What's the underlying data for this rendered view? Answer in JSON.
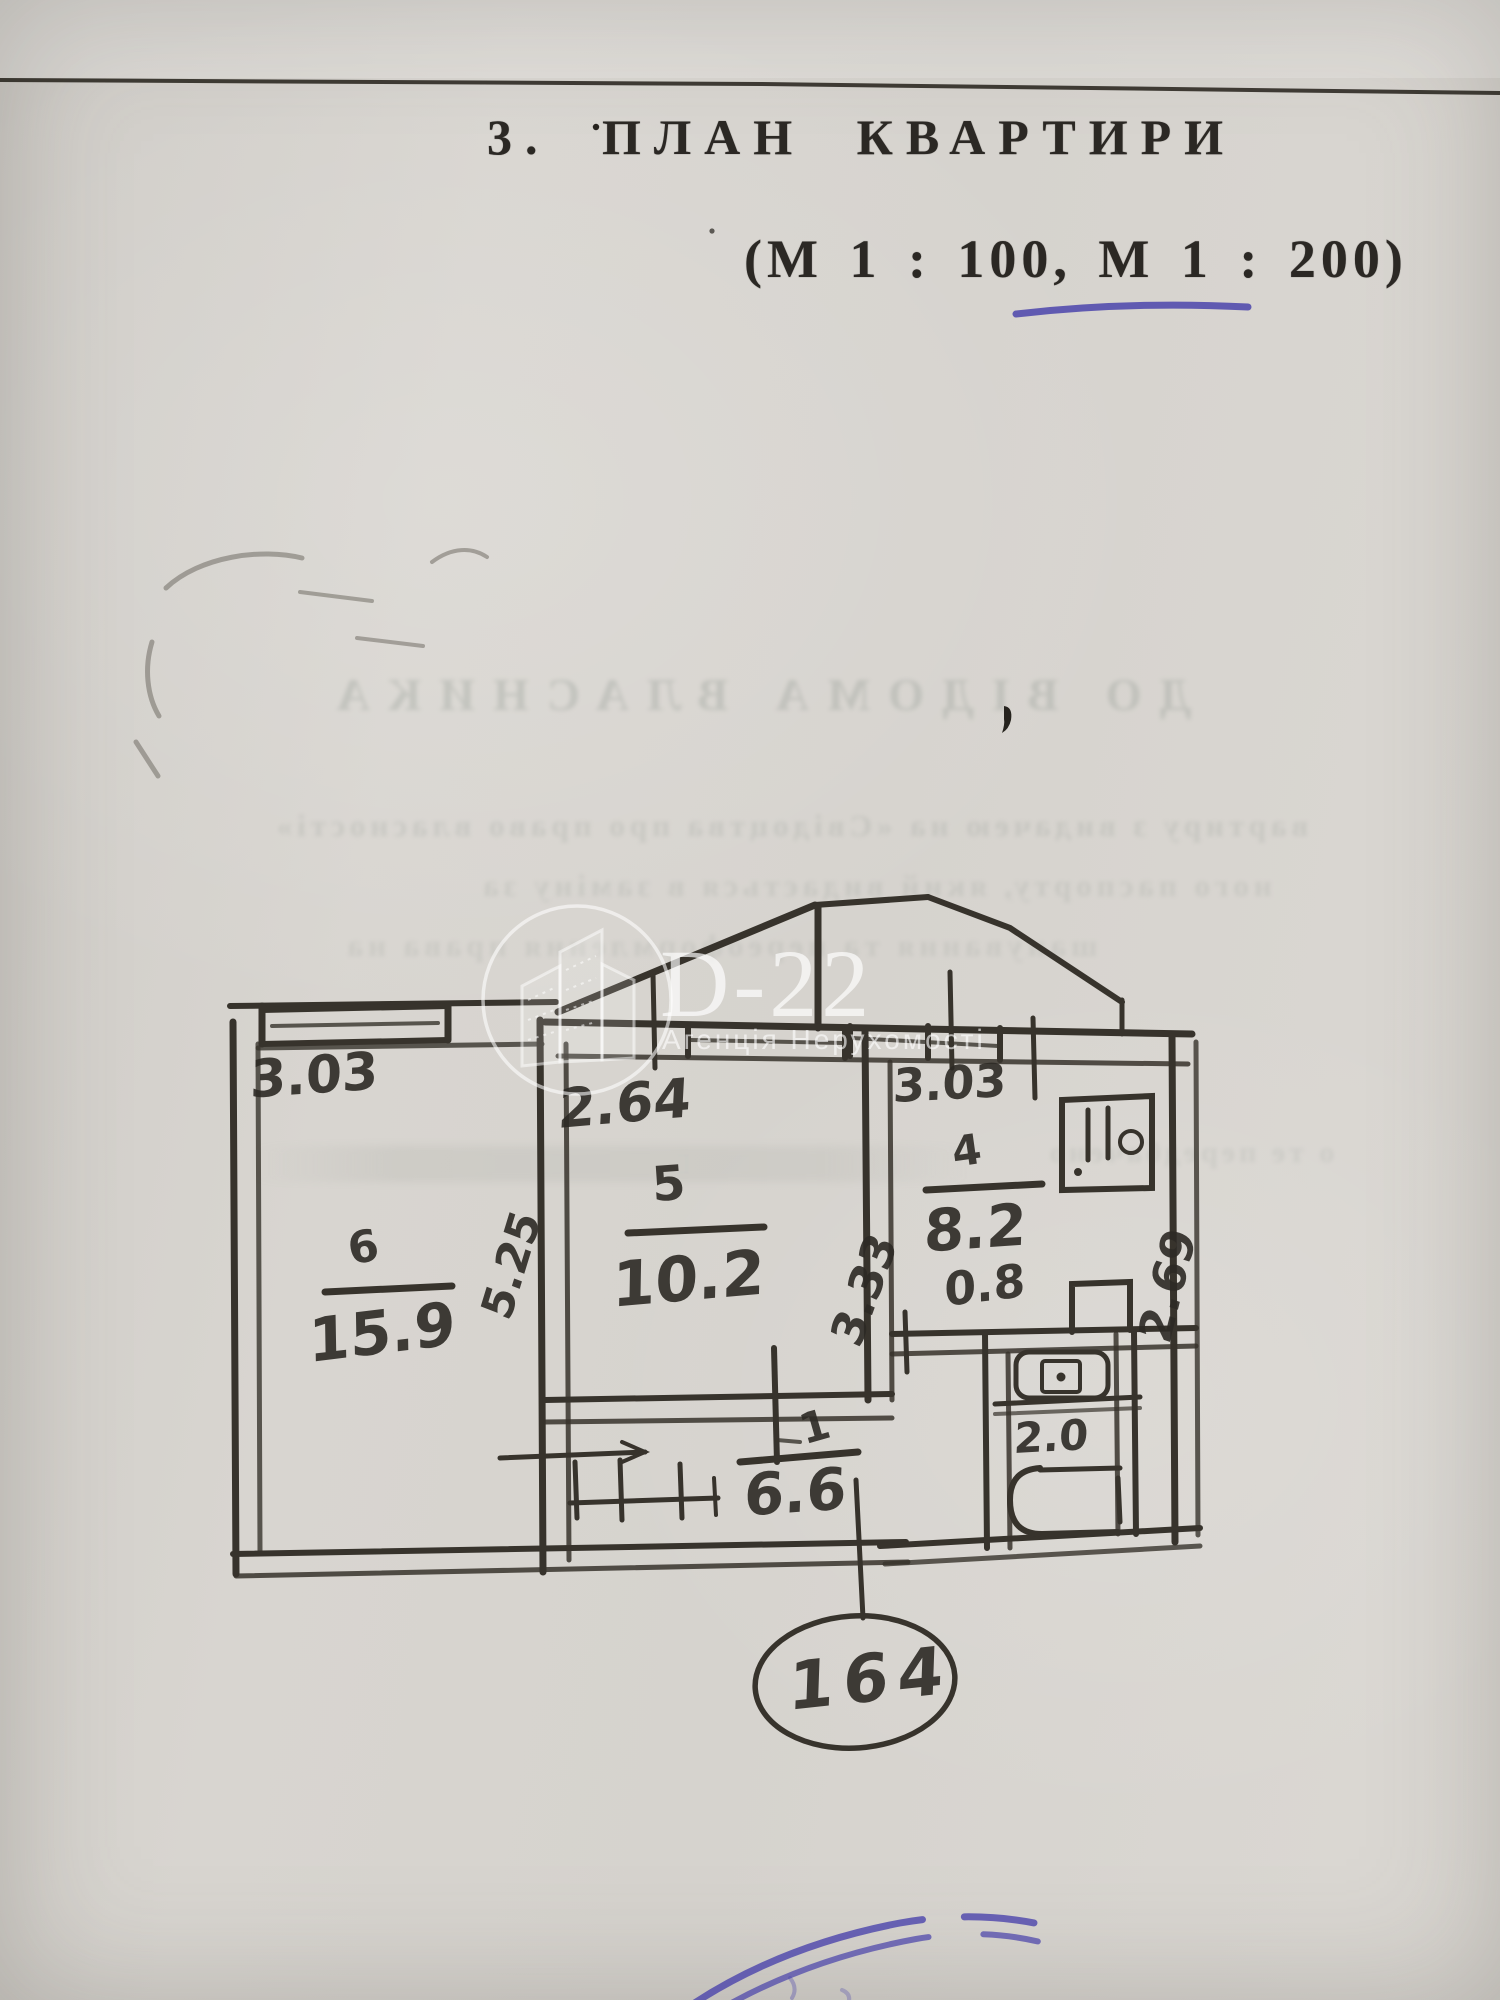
{
  "document": {
    "section_title": "3. ПЛАН КВАРТИРИ",
    "scale_note": "(М 1 : 100, М 1 : 200)"
  },
  "watermark": {
    "brand": "D-22",
    "agency": "Агенція Нерухомості"
  },
  "plan": {
    "rooms": {
      "room6": {
        "number": "6",
        "area": "15.9",
        "width": "3.03",
        "depth": "5.25"
      },
      "room5": {
        "number": "5",
        "area": "10.2",
        "width": "2.64",
        "depth": "3.33"
      },
      "room4": {
        "number": "4",
        "area": "8.2",
        "width": "3.03",
        "depth": "2.69"
      }
    },
    "wc_area": "0.8",
    "bath_area": "2.0",
    "hallway": {
      "number": "1",
      "area": "6.6"
    },
    "apartment_number": "164"
  },
  "bleedthrough": {
    "lines": [
      "ДО ВІДОМА ВЛАСНИКА",
      "вартиру з видачею на «Свідоцтва про право власності»",
      "ного паспорту, який видається в заміну за",
      "шанування та переоформлення права на",
      "о те передбачено"
    ]
  },
  "colors": {
    "stamp_blue": "#4b44ab",
    "underline_blue": "#4b44ab",
    "ink": "#34312b",
    "paper": "#d7d4cf"
  }
}
